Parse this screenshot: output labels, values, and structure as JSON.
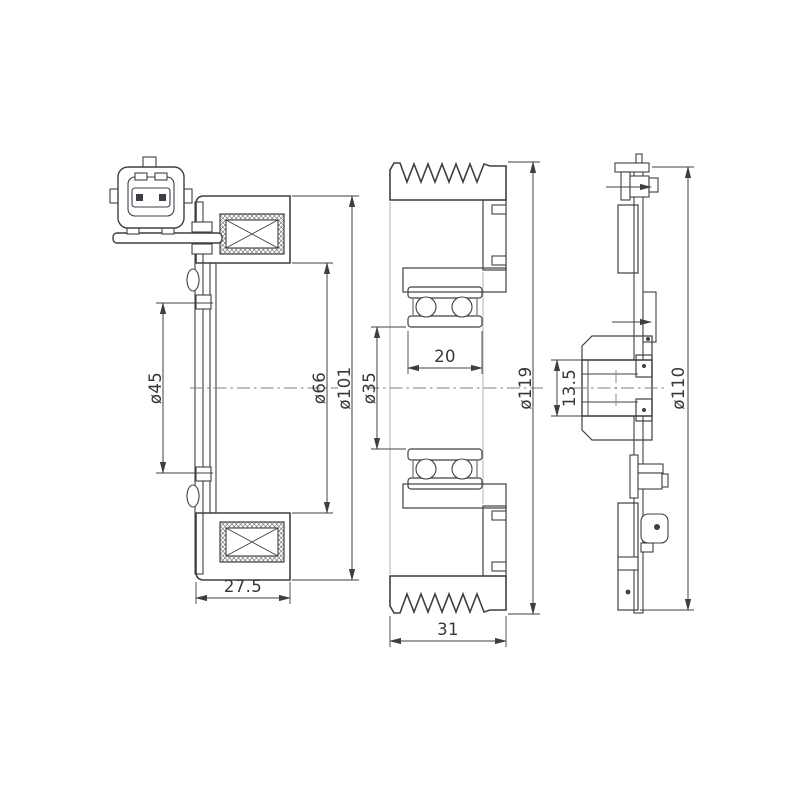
{
  "drawing": {
    "background_color": "#ffffff",
    "line_color": "#3c4046",
    "views": {
      "coil_section": {
        "dim_bore": "ø45",
        "dim_inner_diameter": "ø66",
        "dim_outer_diameter": "ø101",
        "dim_depth": "27.5"
      },
      "pulley_section": {
        "dim_bearing_width": "20",
        "dim_bore": "ø35",
        "dim_outer_diameter": "ø119",
        "dim_depth": "31"
      },
      "hub_plate_section": {
        "dim_hub_depth": "13.5",
        "dim_outer_diameter": "ø110"
      }
    }
  }
}
